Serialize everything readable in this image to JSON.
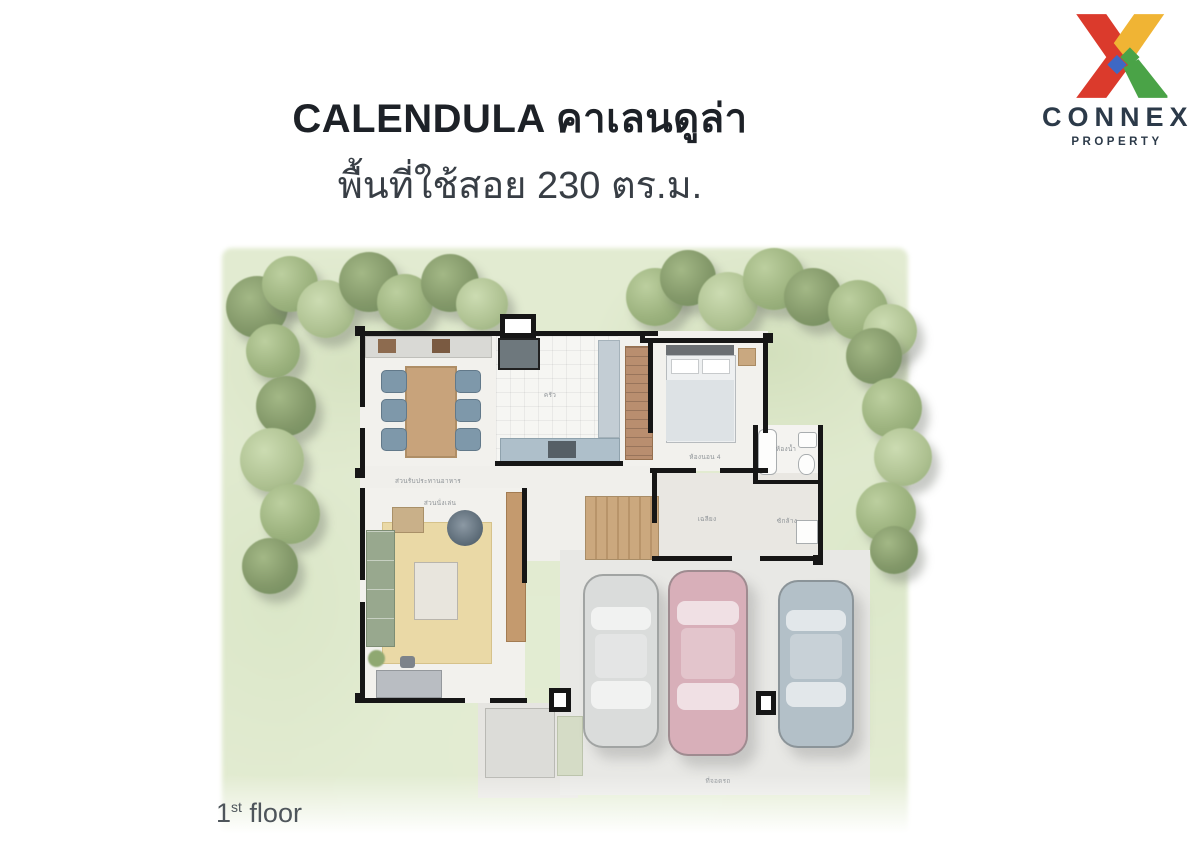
{
  "header": {
    "title": "CALENDULA คาเลนดูล่า",
    "subtitle": "พื้นที่ใช้สอย 230 ตร.ม."
  },
  "logo": {
    "name": "CONNEX",
    "tagline": "PROPERTY",
    "colors": {
      "red": "#DB3A2C",
      "yellow": "#F0B434",
      "green": "#4AA347",
      "blue": "#3E68C4",
      "text": "#2C3A49"
    }
  },
  "plan": {
    "floor_label": {
      "number": "1",
      "ordinal": "st",
      "word": " floor"
    },
    "area_sqm": "230",
    "rooms": [
      {
        "id": "dining",
        "label": "ส่วนรับประทานอาหาร"
      },
      {
        "id": "kitchen",
        "label": "ครัว"
      },
      {
        "id": "bedroom",
        "label": "ห้องนอน 4"
      },
      {
        "id": "bathroom",
        "label": "ห้องน้ำ"
      },
      {
        "id": "living",
        "label": "ส่วนนั่งเล่น"
      },
      {
        "id": "porch",
        "label": "เฉลียง"
      },
      {
        "id": "laundry",
        "label": "ซักล้าง"
      },
      {
        "id": "parking",
        "label": "ที่จอดรถ"
      }
    ],
    "car_colors": [
      "#DADCDB",
      "#D8AFB9",
      "#B3C0C8"
    ]
  }
}
